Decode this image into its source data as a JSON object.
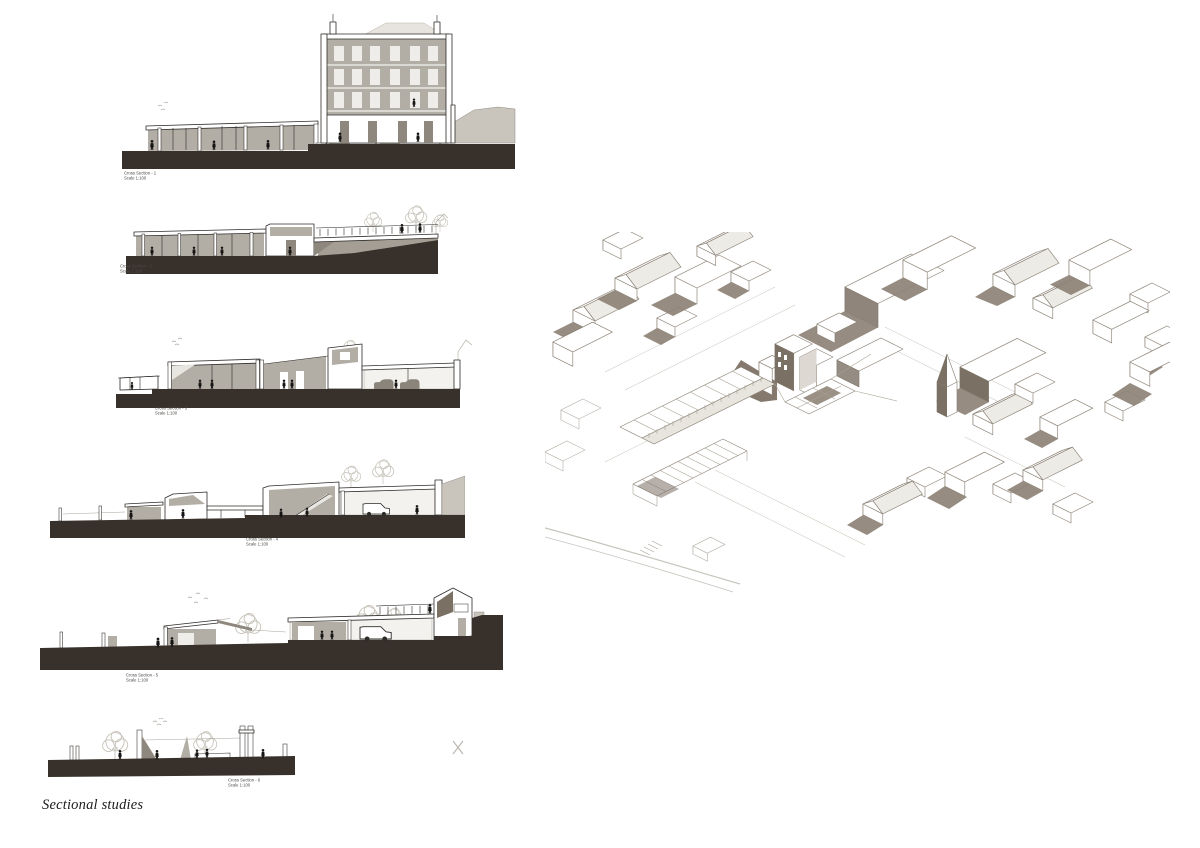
{
  "page": {
    "caption": "Sectional studies",
    "background": "#ffffff"
  },
  "sections": [
    {
      "title": "Cross Section - 1",
      "scale": "Scale 1:100"
    },
    {
      "title": "Cross Section - 2",
      "scale": "Scale 1:100"
    },
    {
      "title": "Cross Section - 3",
      "scale": "Scale 1:100"
    },
    {
      "title": "Cross Section - 4",
      "scale": "Scale 1:100"
    },
    {
      "title": "Cross Section - 5",
      "scale": "Scale 1:100"
    },
    {
      "title": "Cross Section - 6",
      "scale": "Scale 1:100"
    }
  ],
  "palette": {
    "ground_poche": "#38312b",
    "elevation_gray": "#b2ada5",
    "light_gray": "#c9c5bd",
    "section_line": "#2e2c29",
    "axon_line": "#8a8175",
    "axon_shadow": "#8d8276",
    "axon_dark_face": "#7b7064",
    "figure_black": "#151413"
  }
}
